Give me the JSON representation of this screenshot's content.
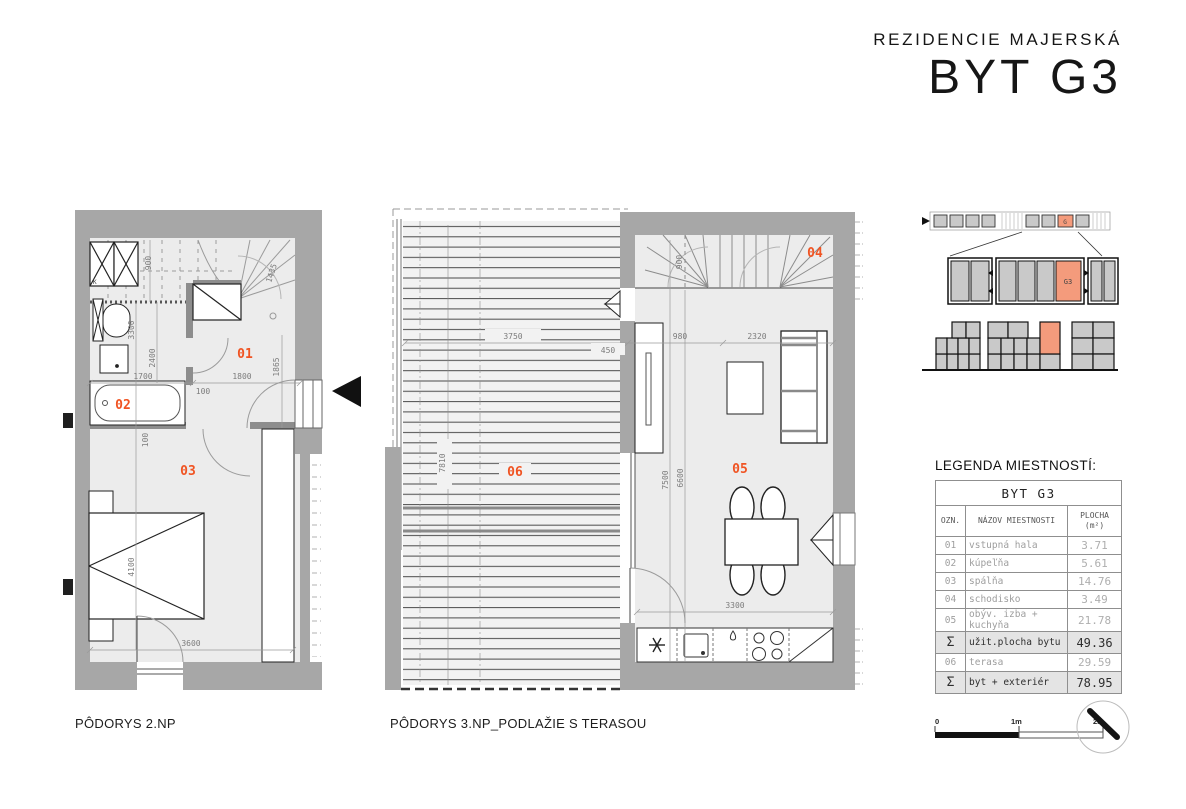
{
  "header": {
    "project": "REZIDENCIE MAJERSKÁ",
    "unit": "BYT G3"
  },
  "plan2": {
    "caption": "PÔDORYS 2.NP",
    "room_labels": {
      "r01": "01",
      "r02": "02",
      "r03": "03"
    },
    "washer_label": "K",
    "dims": {
      "d900": "900",
      "d1435": "1435",
      "d3300": "3300",
      "d2400": "2400",
      "d1700": "1700",
      "d1800": "1800",
      "d100a": "100",
      "d1865": "1865",
      "d100b": "100",
      "d4100": "4100",
      "d3600": "3600"
    }
  },
  "plan3": {
    "caption": "PÔDORYS 3.NP_PODLAŽIE S TERASOU",
    "room_labels": {
      "r04": "04",
      "r05": "05",
      "r06": "06"
    },
    "dims": {
      "d3750": "3750",
      "d450": "450",
      "d7810": "7810",
      "d900": "900",
      "d980": "980",
      "d2320": "2320",
      "d7500": "7500",
      "d6600": "6600",
      "d3300": "3300"
    }
  },
  "diagrams": {
    "site_unit": "G",
    "row_unit": "G3"
  },
  "legend": {
    "heading": "LEGENDA MIESTNOSTÍ:",
    "table_title": "BYT G3",
    "col_ozn": "OZN.",
    "col_name": "NÁZOV MIESTNOSTI",
    "col_area1": "PLOCHA",
    "col_area2": "(m²)",
    "rows": [
      {
        "ozn": "01",
        "name": "vstupná hala",
        "area": "3.71"
      },
      {
        "ozn": "02",
        "name": "kúpeľňa",
        "area": "5.61"
      },
      {
        "ozn": "03",
        "name": "spálňa",
        "area": "14.76"
      },
      {
        "ozn": "04",
        "name": "schodisko",
        "area": "3.49"
      },
      {
        "ozn": "05",
        "name": "obýv. izba + kuchyňa",
        "area": "21.78"
      },
      {
        "ozn": "Σ",
        "name": "užit.plocha bytu",
        "area": "49.36"
      },
      {
        "ozn": "06",
        "name": "terasa",
        "area": "29.59"
      },
      {
        "ozn": "Σ",
        "name": "byt + exteriér",
        "area": "78.95"
      }
    ]
  },
  "scalebar": {
    "t0": "0",
    "t1": "1m",
    "t2": "2m"
  },
  "colors": {
    "accent": "#f05423",
    "highlight": "#f49b7c",
    "wall": "#a7a7a7",
    "floor": "#ececec"
  }
}
